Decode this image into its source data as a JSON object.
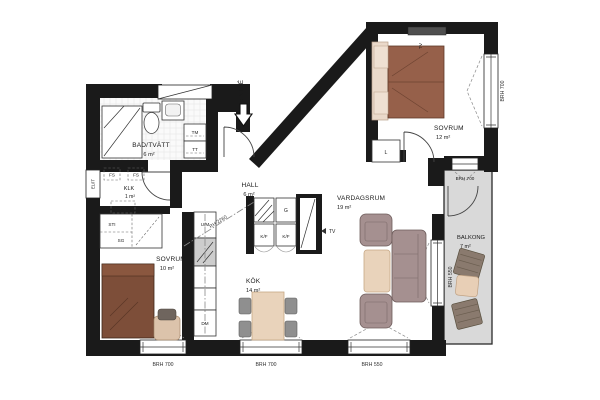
{
  "rooms": {
    "bathroom": {
      "name": "BAD/TVÄTT",
      "area": "6 m²"
    },
    "hall": {
      "name": "HALL",
      "area": "6 m²"
    },
    "closet": {
      "name": "KLK",
      "area": "1 m²"
    },
    "bedroom_small": {
      "name": "SOVRUM",
      "area": "10 m²"
    },
    "kitchen": {
      "name": "KÖK",
      "area": "14 m²"
    },
    "living": {
      "name": "VARDAGSRUM",
      "area": "19 m²"
    },
    "bedroom_large": {
      "name": "SOVRUM",
      "area": "12 m²"
    },
    "balcony": {
      "name": "BALKONG",
      "area": "7 m²"
    }
  },
  "fixtures": {
    "washing_machine": "TM",
    "dryer": "TT",
    "dishwasher": "DM",
    "oven_microwave": "U/M",
    "fridge_freezer_left": "K/F",
    "fridge_freezer_right": "K/F",
    "wardrobe": "G",
    "linen_closet": "L",
    "tv_bedroom": "TV",
    "tv_living": "TV",
    "electrical_cabinet": "EL/IT",
    "shaft_top_left": "FS",
    "shaft_top_right": "FS",
    "shaft_bottom": "FS",
    "riser": "STI",
    "wardrobe_small": "SG"
  },
  "annotations": {
    "entrance": "ENTRÉ",
    "ceiling_height_note": "RH 2260"
  },
  "window_labels": {
    "bottom_left": "BRH 700",
    "bottom_middle": "BRH 700",
    "bottom_right": "BRH 550",
    "bedroom_right": "BRH 700",
    "balcony_top": "BRH 700",
    "balcony_side": "BRH 550"
  },
  "colors": {
    "wall": "#1a1a1a",
    "balcony_floor": "#d9d9d9",
    "bed_brown": "#96604a",
    "bed_dark_brown": "#7d4e39",
    "upholstery_gray": "#a59090",
    "wood_beige": "#e9d3bb",
    "pillow_beige": "#ead9ca",
    "chair_gray": "#8f8f8f",
    "outdoor_furniture": "#8a7a6e"
  }
}
